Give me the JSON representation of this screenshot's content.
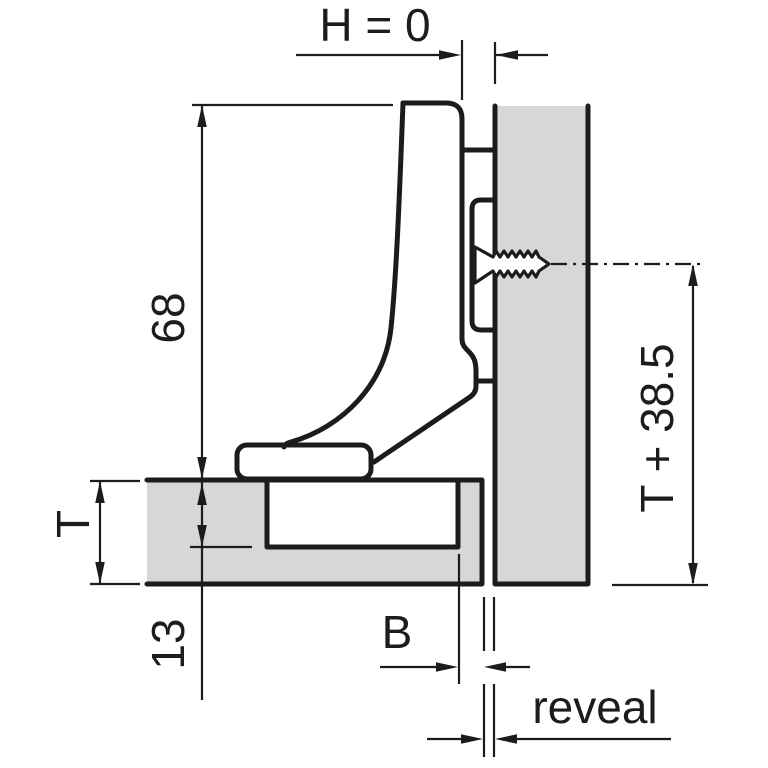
{
  "drawing": {
    "title": "hinge-inset-application-drawing",
    "labels": {
      "overlay": "H = 0",
      "arm_height": "68",
      "door_thickness": "T",
      "cup_depth": "13",
      "drilling_distance": "B",
      "reveal": "reveal",
      "mounting_height": "T + 38.5"
    },
    "colors": {
      "panel_fill": "#d7d7d7",
      "line": "#1c1c1c",
      "background": "#ffffff"
    }
  }
}
